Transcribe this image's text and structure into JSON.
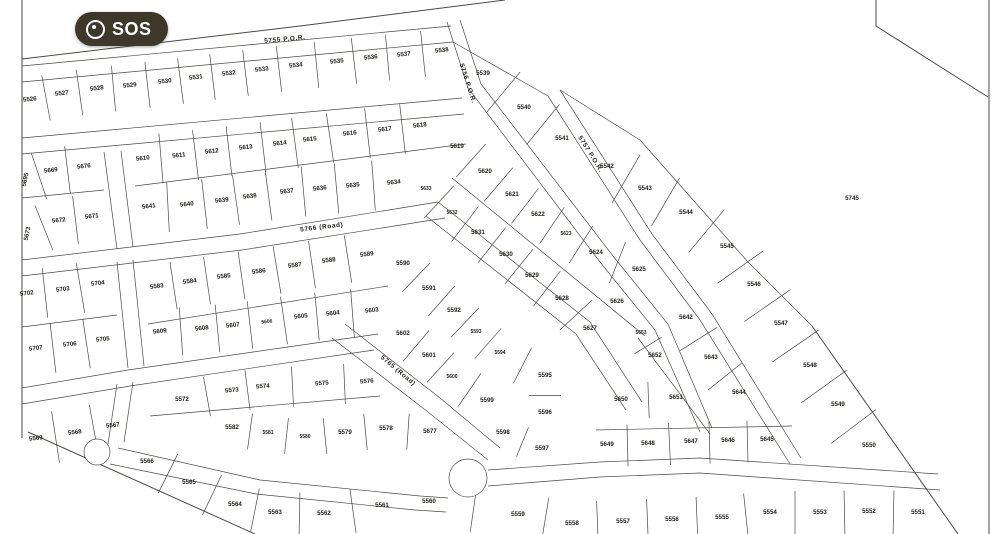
{
  "badge": {
    "label": "SOS"
  },
  "scale": {
    "label": "Scale 1:500",
    "x": 140,
    "y": 16
  },
  "map": {
    "background": "#ffffff",
    "line_color": "#4d4a45",
    "label_color": "#201d18",
    "badge_color": "#3e382b"
  },
  "roads": [
    {
      "label": "5755 P.O.R.",
      "x": 285,
      "y": 41,
      "r": -5
    },
    {
      "label": "5756 P.O.R.",
      "x": 466,
      "y": 84,
      "r": 72
    },
    {
      "label": "5757 P.O.R.",
      "x": 589,
      "y": 155,
      "r": 58
    },
    {
      "label": "5766 (Road)",
      "x": 322,
      "y": 229,
      "r": -7
    },
    {
      "label": "5765 (Road)",
      "x": 397,
      "y": 372,
      "r": 40
    }
  ],
  "lots": [
    [
      "5526",
      30,
      101,
      -6
    ],
    [
      "5527",
      62,
      95,
      -6
    ],
    [
      "5528",
      97,
      90,
      -6
    ],
    [
      "5529",
      130,
      87,
      -6
    ],
    [
      "5530",
      165,
      83,
      -6
    ],
    [
      "5531",
      196,
      79,
      -6
    ],
    [
      "5532",
      229,
      75,
      -6
    ],
    [
      "5533",
      262,
      71,
      -6
    ],
    [
      "5534",
      296,
      67,
      -6
    ],
    [
      "5535",
      337,
      63,
      -6
    ],
    [
      "5536",
      371,
      59,
      -6
    ],
    [
      "5537",
      404,
      56,
      -6
    ],
    [
      "5538",
      442,
      52,
      -6
    ],
    [
      "5539",
      483,
      75
    ],
    [
      "5540",
      524,
      109
    ],
    [
      "5541",
      562,
      140
    ],
    [
      "5542",
      607,
      168
    ],
    [
      "5543",
      645,
      190
    ],
    [
      "5544",
      686,
      214
    ],
    [
      "5545",
      727,
      248
    ],
    [
      "5546",
      754,
      286
    ],
    [
      "5547",
      781,
      325
    ],
    [
      "5548",
      810,
      367
    ],
    [
      "5549",
      838,
      406
    ],
    [
      "5550",
      869,
      447
    ],
    [
      "5745",
      852,
      200
    ],
    [
      "5695",
      27,
      180,
      -78
    ],
    [
      "5669",
      51,
      172,
      -6
    ],
    [
      "5676",
      84,
      168,
      -6
    ],
    [
      "5610",
      143,
      160,
      -6
    ],
    [
      "5611",
      179,
      157,
      -6
    ],
    [
      "5612",
      212,
      153,
      -6
    ],
    [
      "5613",
      246,
      149,
      -6
    ],
    [
      "5614",
      280,
      145,
      -6
    ],
    [
      "5615",
      310,
      141,
      -6
    ],
    [
      "5616",
      350,
      135,
      -6
    ],
    [
      "5617",
      385,
      131,
      -6
    ],
    [
      "5618",
      420,
      127,
      -6
    ],
    [
      "5673",
      29,
      234,
      -78
    ],
    [
      "5672",
      59,
      222,
      -6
    ],
    [
      "5671",
      92,
      218,
      -6
    ],
    [
      "5641",
      149,
      208,
      -6
    ],
    [
      "5640",
      187,
      206,
      -6
    ],
    [
      "5639",
      222,
      202,
      -6
    ],
    [
      "5638",
      250,
      198,
      -6
    ],
    [
      "5637",
      287,
      193,
      -6
    ],
    [
      "5636",
      320,
      190,
      -6
    ],
    [
      "5635",
      353,
      187,
      -6
    ],
    [
      "5634",
      394,
      184,
      -6
    ],
    [
      "5619",
      457,
      148
    ],
    [
      "5620",
      485,
      173
    ],
    [
      "5621",
      512,
      196
    ],
    [
      "5622",
      538,
      216
    ],
    [
      "5623",
      566,
      235,
      0,
      5
    ],
    [
      "5624",
      596,
      254
    ],
    [
      "5625",
      639,
      271
    ],
    [
      "5633",
      426,
      190,
      0,
      5
    ],
    [
      "5632",
      452,
      214,
      0,
      5
    ],
    [
      "5631",
      478,
      234
    ],
    [
      "5630",
      506,
      256
    ],
    [
      "5629",
      532,
      277
    ],
    [
      "5628",
      562,
      300
    ],
    [
      "5627",
      590,
      330
    ],
    [
      "5626",
      617,
      303
    ],
    [
      "5583",
      157,
      288,
      -7
    ],
    [
      "5584",
      190,
      283,
      -7
    ],
    [
      "5585",
      224,
      278,
      -7
    ],
    [
      "5586",
      259,
      273,
      -7
    ],
    [
      "5587",
      295,
      267,
      -7
    ],
    [
      "5588",
      329,
      262,
      -7
    ],
    [
      "5589",
      367,
      256,
      -7
    ],
    [
      "5590",
      403,
      265
    ],
    [
      "5591",
      429,
      290
    ],
    [
      "5592",
      454,
      312
    ],
    [
      "5593",
      476,
      333,
      0,
      5
    ],
    [
      "5594",
      500,
      354,
      0,
      5
    ],
    [
      "5595",
      545,
      377
    ],
    [
      "5596",
      545,
      414
    ],
    [
      "5609",
      160,
      333,
      -6
    ],
    [
      "5608",
      202,
      330,
      -6
    ],
    [
      "5607",
      233,
      327,
      -6
    ],
    [
      "5606",
      267,
      323,
      -6,
      5
    ],
    [
      "5605",
      301,
      318,
      -6
    ],
    [
      "5604",
      333,
      315,
      -6
    ],
    [
      "5603",
      372,
      312,
      -6
    ],
    [
      "5602",
      403,
      335
    ],
    [
      "5601",
      429,
      357
    ],
    [
      "5600",
      452,
      378,
      0,
      5
    ],
    [
      "5599",
      487,
      402
    ],
    [
      "5598",
      503,
      434
    ],
    [
      "5597",
      542,
      450
    ],
    [
      "5572",
      182,
      401
    ],
    [
      "5573",
      232,
      392,
      -5
    ],
    [
      "5574",
      263,
      388,
      -5
    ],
    [
      "5575",
      322,
      385,
      -5
    ],
    [
      "5576",
      367,
      383,
      -5
    ],
    [
      "5582",
      232,
      429
    ],
    [
      "5581",
      268,
      434,
      0,
      5
    ],
    [
      "5580",
      305,
      438,
      0,
      5
    ],
    [
      "5579",
      345,
      434
    ],
    [
      "5578",
      386,
      430
    ],
    [
      "5677",
      430,
      433
    ],
    [
      "5702",
      27,
      295,
      -6
    ],
    [
      "5703",
      63,
      291,
      -6
    ],
    [
      "5704",
      98,
      285,
      -6
    ],
    [
      "5707",
      36,
      350,
      -6
    ],
    [
      "5706",
      70,
      346,
      -6
    ],
    [
      "5705",
      103,
      341,
      -6
    ],
    [
      "5569",
      36,
      440,
      -6
    ],
    [
      "5568",
      75,
      434,
      -6
    ],
    [
      "5567",
      113,
      427,
      -6
    ],
    [
      "5566",
      147,
      463
    ],
    [
      "5565",
      189,
      484
    ],
    [
      "5564",
      235,
      506
    ],
    [
      "5563",
      275,
      514
    ],
    [
      "5562",
      324,
      515
    ],
    [
      "5561",
      382,
      507
    ],
    [
      "5642",
      686,
      319
    ],
    [
      "5653",
      641,
      334,
      0,
      5
    ],
    [
      "5652",
      655,
      357
    ],
    [
      "5643",
      711,
      359
    ],
    [
      "5644",
      739,
      394
    ],
    [
      "5651",
      676,
      399
    ],
    [
      "5650",
      621,
      401
    ],
    [
      "5649",
      607,
      446
    ],
    [
      "5648",
      648,
      445
    ],
    [
      "5647",
      691,
      443
    ],
    [
      "5646",
      728,
      442
    ],
    [
      "5645",
      767,
      441
    ],
    [
      "5560",
      429,
      503
    ],
    [
      "5559",
      518,
      516
    ],
    [
      "5558",
      572,
      525
    ],
    [
      "5557",
      623,
      523
    ],
    [
      "5556",
      672,
      521
    ],
    [
      "5555",
      722,
      519
    ],
    [
      "5554",
      770,
      514
    ],
    [
      "5553",
      820,
      514
    ],
    [
      "5552",
      869,
      513
    ],
    [
      "5551",
      918,
      514
    ]
  ]
}
